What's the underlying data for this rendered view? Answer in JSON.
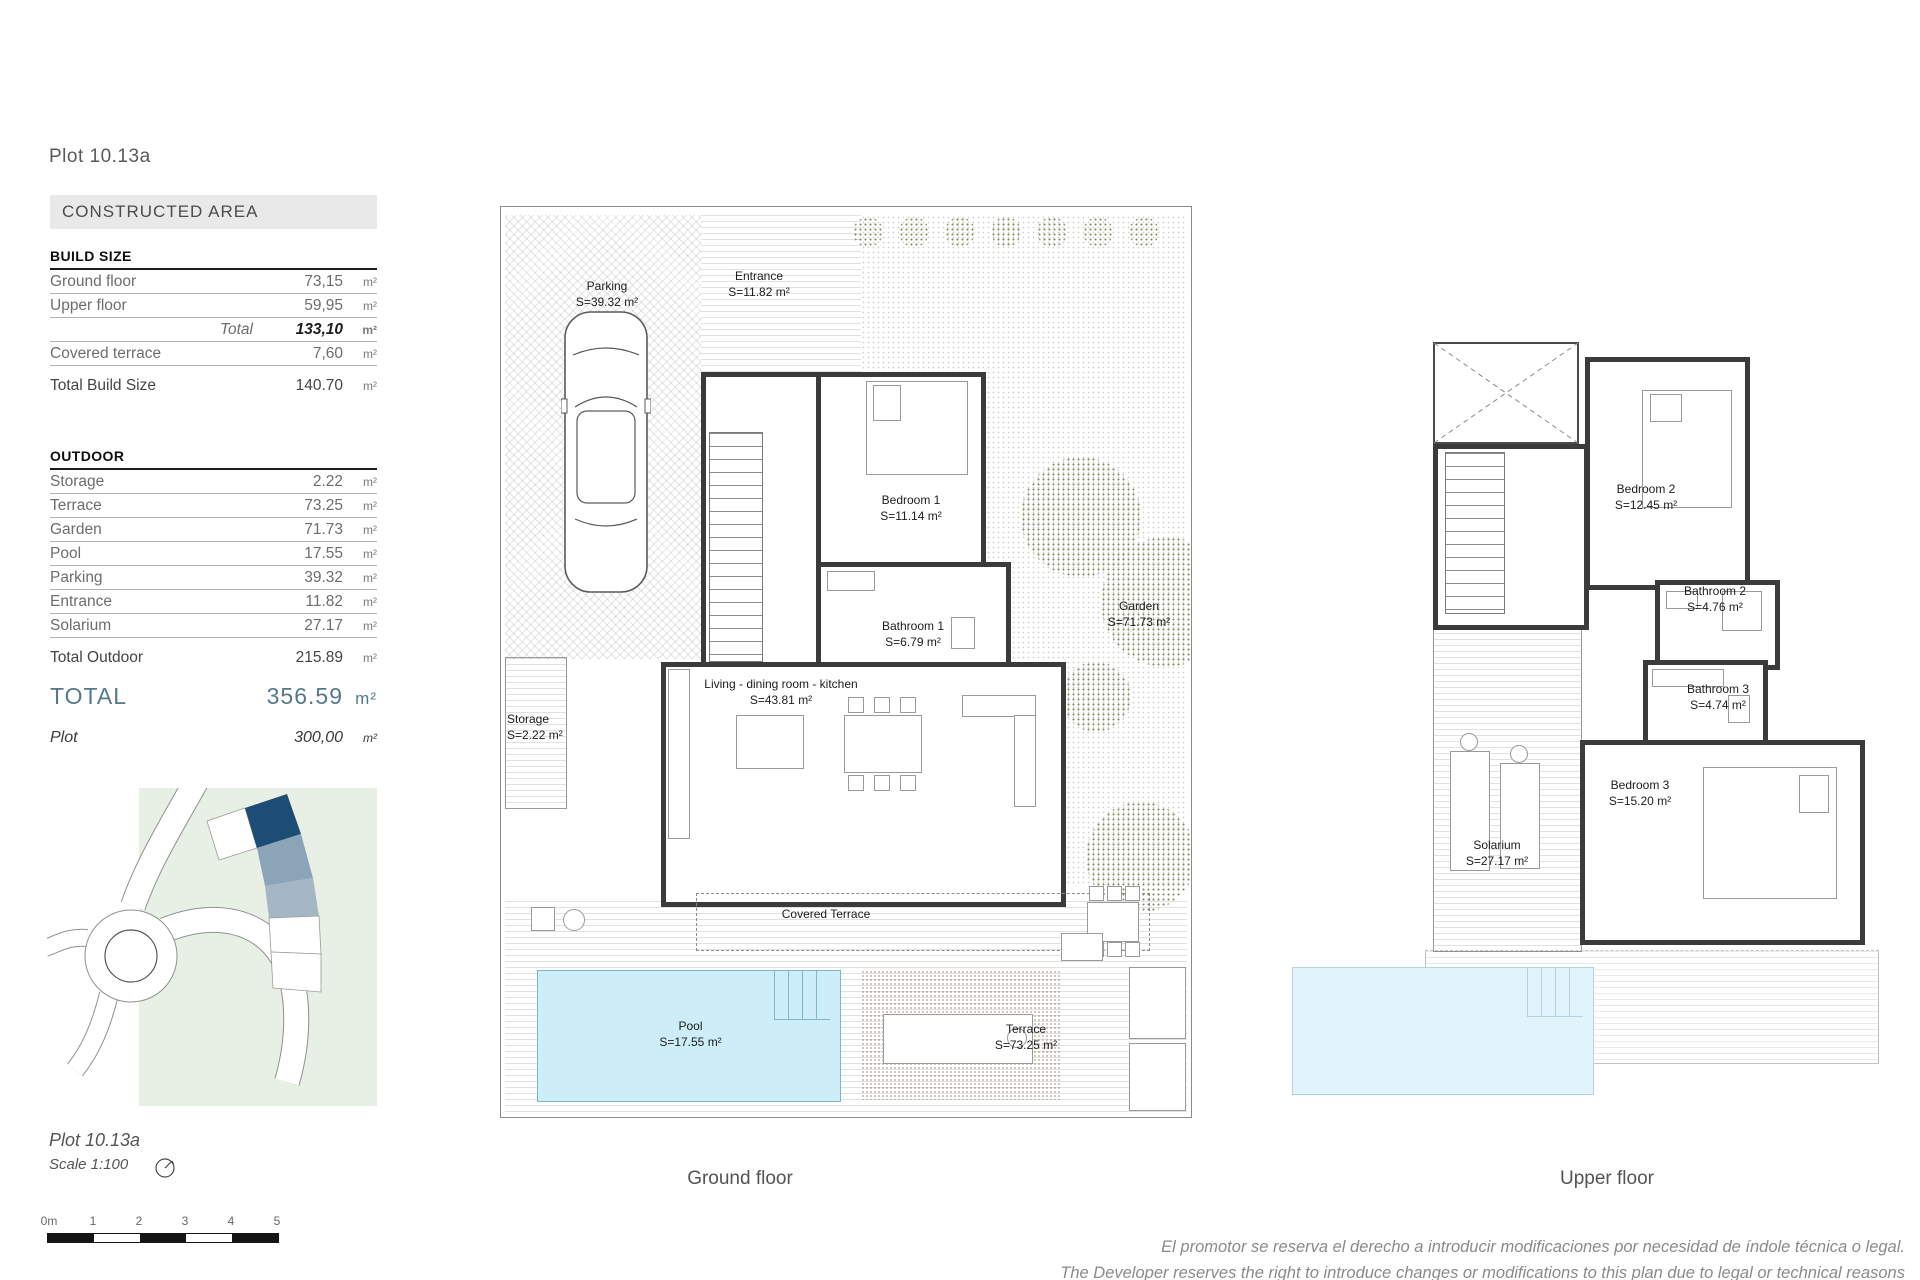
{
  "header": {
    "plot_title": "Plot 10.13a",
    "section_title": "CONSTRUCTED AREA"
  },
  "build_size": {
    "title": "BUILD SIZE",
    "unit": "m²",
    "rows": [
      {
        "label": "Ground floor",
        "value": "73,15"
      },
      {
        "label": "Upper floor",
        "value": "59,95"
      }
    ],
    "total": {
      "label": "Total",
      "value": "133,10"
    },
    "covered": {
      "label": "Covered terrace",
      "value": "7,60"
    },
    "total_build": {
      "label": "Total Build Size",
      "value": "140.70"
    }
  },
  "outdoor": {
    "title": "OUTDOOR",
    "unit": "m²",
    "rows": [
      {
        "label": "Storage",
        "value": "2.22"
      },
      {
        "label": "Terrace",
        "value": "73.25"
      },
      {
        "label": "Garden",
        "value": "71.73"
      },
      {
        "label": "Pool",
        "value": "17.55"
      },
      {
        "label": "Parking",
        "value": "39.32"
      },
      {
        "label": "Entrance",
        "value": "11.82"
      },
      {
        "label": "Solarium",
        "value": "27.17"
      }
    ],
    "total": {
      "label": "Total Outdoor",
      "value": "215.89"
    }
  },
  "summary": {
    "total_label": "TOTAL",
    "total_value": "356.59",
    "unit": "m²",
    "plot_label": "Plot",
    "plot_value": "300,00"
  },
  "footer_left": {
    "plot_title": "Plot 10.13a",
    "scale": "Scale 1:100",
    "scalebar": [
      "0m",
      "1",
      "2",
      "3",
      "4",
      "5"
    ]
  },
  "ground_floor": {
    "caption": "Ground floor",
    "rooms": [
      {
        "name": "Parking",
        "area": "S=39.32 m²"
      },
      {
        "name": "Entrance",
        "area": "S=11.82 m²"
      },
      {
        "name": "Bedroom 1",
        "area": "S=11.14 m²"
      },
      {
        "name": "Bathroom 1",
        "area": "S=6.79 m²"
      },
      {
        "name": "Living - dining  room - kitchen",
        "area": "S=43.81 m²"
      },
      {
        "name": "Storage",
        "area": "S=2.22 m²"
      },
      {
        "name": "Garden",
        "area": "S=71.73 m²"
      },
      {
        "name": "Covered Terrace",
        "area": ""
      },
      {
        "name": "Pool",
        "area": "S=17.55 m²"
      },
      {
        "name": "Terrace",
        "area": "S=73.25 m²"
      }
    ]
  },
  "upper_floor": {
    "caption": "Upper floor",
    "rooms": [
      {
        "name": "Bedroom 2",
        "area": "S=12.45 m²"
      },
      {
        "name": "Bathroom 2",
        "area": "S=4.76 m²"
      },
      {
        "name": "Bathroom 3",
        "area": "S=4.74 m²"
      },
      {
        "name": "Bedroom 3",
        "area": "S=15.20 m²"
      },
      {
        "name": "Solarium",
        "area": "S=27.17 m²"
      }
    ]
  },
  "disclaimer": {
    "line1": "El promotor se reserva el derecho a introducir modificaciones por necesidad de índole técnica o legal.",
    "line2": "The Developer reserves the right to introduce changes or modifications to this plan due to legal or technical reasons"
  },
  "colors": {
    "accent": "#56788a",
    "pool_water": "#cdeef9",
    "site_plot_highlight": "#1d4d74",
    "site_plot_secondary": "#8ba4b8",
    "site_green": "#e8efe5"
  }
}
